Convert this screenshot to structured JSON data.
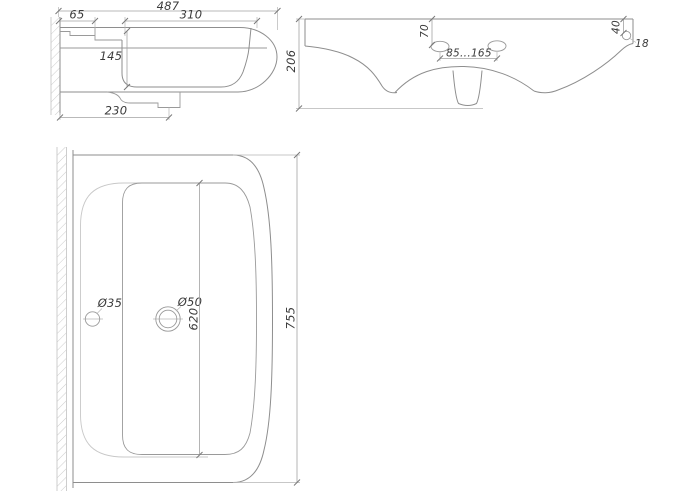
{
  "colors": {
    "background": "#ffffff",
    "main_line": "#8e8e8e",
    "light_line": "#c8c8c8",
    "dimension_line": "#a2a2a2",
    "text": "#3b3b3b"
  },
  "drawing": {
    "side_view": {
      "overall_width": "487",
      "ledge_width": "65",
      "bowl_width": "310",
      "bowl_depth": "145",
      "drain_offset": "230"
    },
    "front_view": {
      "height": "206",
      "faucet_hole_drop": "70",
      "faucet_hole_spacing": "85...165",
      "overflow_hole_drop": "40",
      "overflow_hole_diameter": "18"
    },
    "plan_view": {
      "faucet_hole_diameter": "Ø35",
      "drain_hole_diameter": "Ø50",
      "bowl_length": "620",
      "overall_length": "755"
    }
  }
}
